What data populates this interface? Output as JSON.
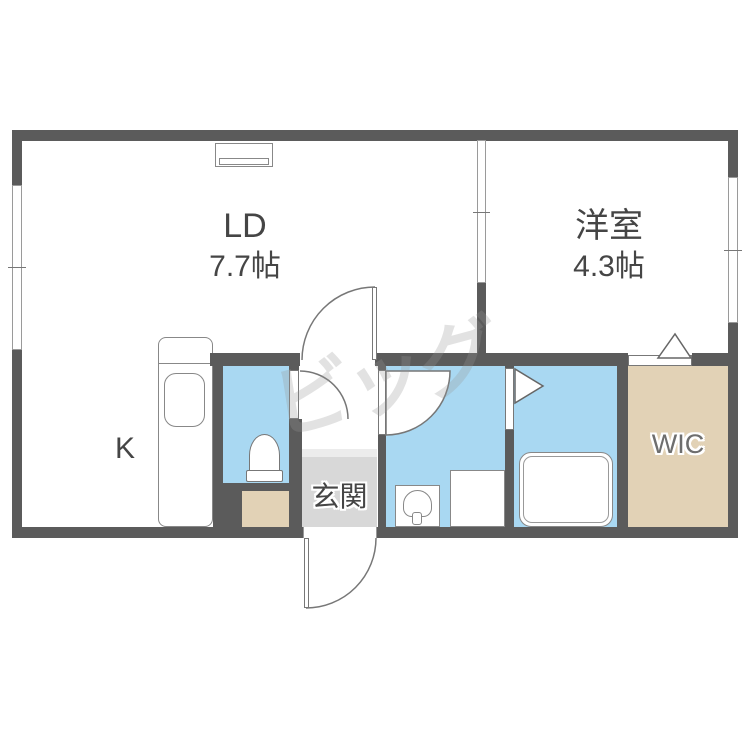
{
  "rooms": {
    "ld": {
      "name": "LD",
      "size": "7.7帖"
    },
    "youshitsu": {
      "name": "洋室",
      "size": "4.3帖"
    },
    "kitchen": {
      "label": "K"
    },
    "genkan": {
      "label": "玄関"
    },
    "wic": {
      "label": "WIC"
    }
  },
  "watermark": {
    "text": "ビッグ"
  },
  "colors": {
    "wall": "#5b5b5b",
    "wet": "#a9d8f2",
    "closet": "#e2d2b6",
    "genkan": "#d8d8d8",
    "step": "#ececec",
    "fixture": "#888888",
    "textdark": "#454545",
    "textgray": "#6e6e6e"
  }
}
